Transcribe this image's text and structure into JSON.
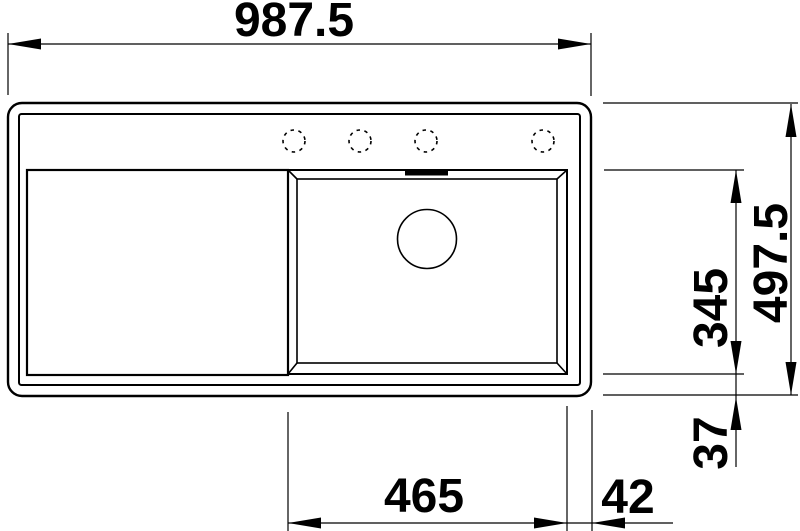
{
  "drawing": {
    "title": "sink-top-view-technical-drawing",
    "background_color": "#ffffff",
    "line_color": "#000000",
    "dimensions": {
      "overall_width": "987.5",
      "overall_depth": "497.5",
      "bowl_depth": "345",
      "bowl_bottom_offset": "37",
      "bowl_width": "465",
      "bowl_right_offset": "42"
    },
    "features": {
      "faucet_hole_count": 4,
      "parts": [
        "sink-body",
        "rim",
        "drainboard",
        "bowl",
        "drain",
        "overflow-slot",
        "faucet-holes"
      ]
    }
  }
}
